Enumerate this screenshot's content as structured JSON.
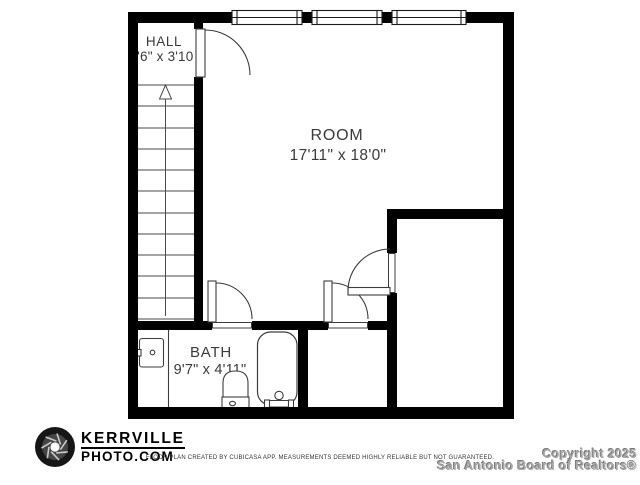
{
  "floor_plan": {
    "rooms": [
      {
        "name": "HALL",
        "dimensions": "3'6\" x 3'10\""
      },
      {
        "name": "ROOM",
        "dimensions": "17'11\" x 18'0\""
      },
      {
        "name": "BATH",
        "dimensions": "9'7\" x 4'11\""
      }
    ],
    "features": [
      "stairs-up-arrow",
      "three-windows-top-wall",
      "four-door-swings",
      "sink",
      "toilet",
      "bathtub"
    ],
    "colors": {
      "wall": "#000000",
      "fixture_line": "#3c3c3c",
      "label_text": "#3a3a3a",
      "watermark_gray": "#a8a8a8"
    }
  },
  "footer": {
    "logo_icon": "camera-aperture-icon",
    "logo_line1": "KERRVILLE",
    "logo_line2": "PHOTO.COM",
    "disclaimer": "FLOOR PLAN CREATED BY CUBICASA APP. MEASUREMENTS DEEMED HIGHLY RELIABLE BUT NOT GUARANTEED.",
    "copyright_line1": "Copyright 2025",
    "copyright_line2": "San Antonio Board of Realtors®"
  }
}
